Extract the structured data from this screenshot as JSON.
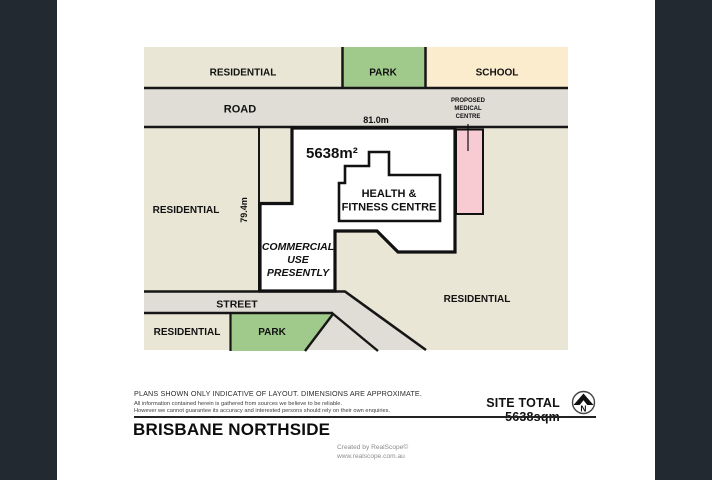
{
  "canvas": {
    "frame_color": "#232930",
    "background": "#ffffff"
  },
  "plan": {
    "colors": {
      "residential": "#e9e6d6",
      "park": "#a0ca8b",
      "school": "#fbeccd",
      "road": "#dfddd6",
      "medical": "#f8cad1",
      "site": "#ffffff",
      "line": "#161616"
    },
    "labels": {
      "residential_top": "RESIDENTIAL",
      "park_top": "PARK",
      "school": "SCHOOL",
      "road": "ROAD",
      "frontage_dim": "81.0m",
      "depth_dim": "79.4m",
      "site_area": "5638m²",
      "proposed_1": "PROPOSED",
      "proposed_2": "MEDICAL",
      "proposed_3": "CENTRE",
      "building_1": "HEALTH &",
      "building_2": "FITNESS CENTRE",
      "commercial_1": "COMMERCIAL",
      "commercial_2": "USE",
      "commercial_3": "PRESENTLY",
      "residential_left": "RESIDENTIAL",
      "residential_right": "RESIDENTIAL",
      "residential_bottom": "RESIDENTIAL",
      "park_bottom": "PARK",
      "street": "STREET"
    }
  },
  "footer": {
    "disclaimer_1": "PLANS SHOWN ONLY INDICATIVE OF LAYOUT.  DIMENSIONS ARE APPROXIMATE.",
    "disclaimer_2": "All information contained herein is gathered from sources we believe to be reliable.",
    "disclaimer_3": "However we cannot guarantee its accuracy and interested persons should rely on their own enquiries.",
    "site_total": "SITE TOTAL 5638sqm",
    "north": "N",
    "title": "BRISBANE NORTHSIDE",
    "credit_1": "Created by RealScope©",
    "credit_2": "www.realscope.com.au"
  }
}
